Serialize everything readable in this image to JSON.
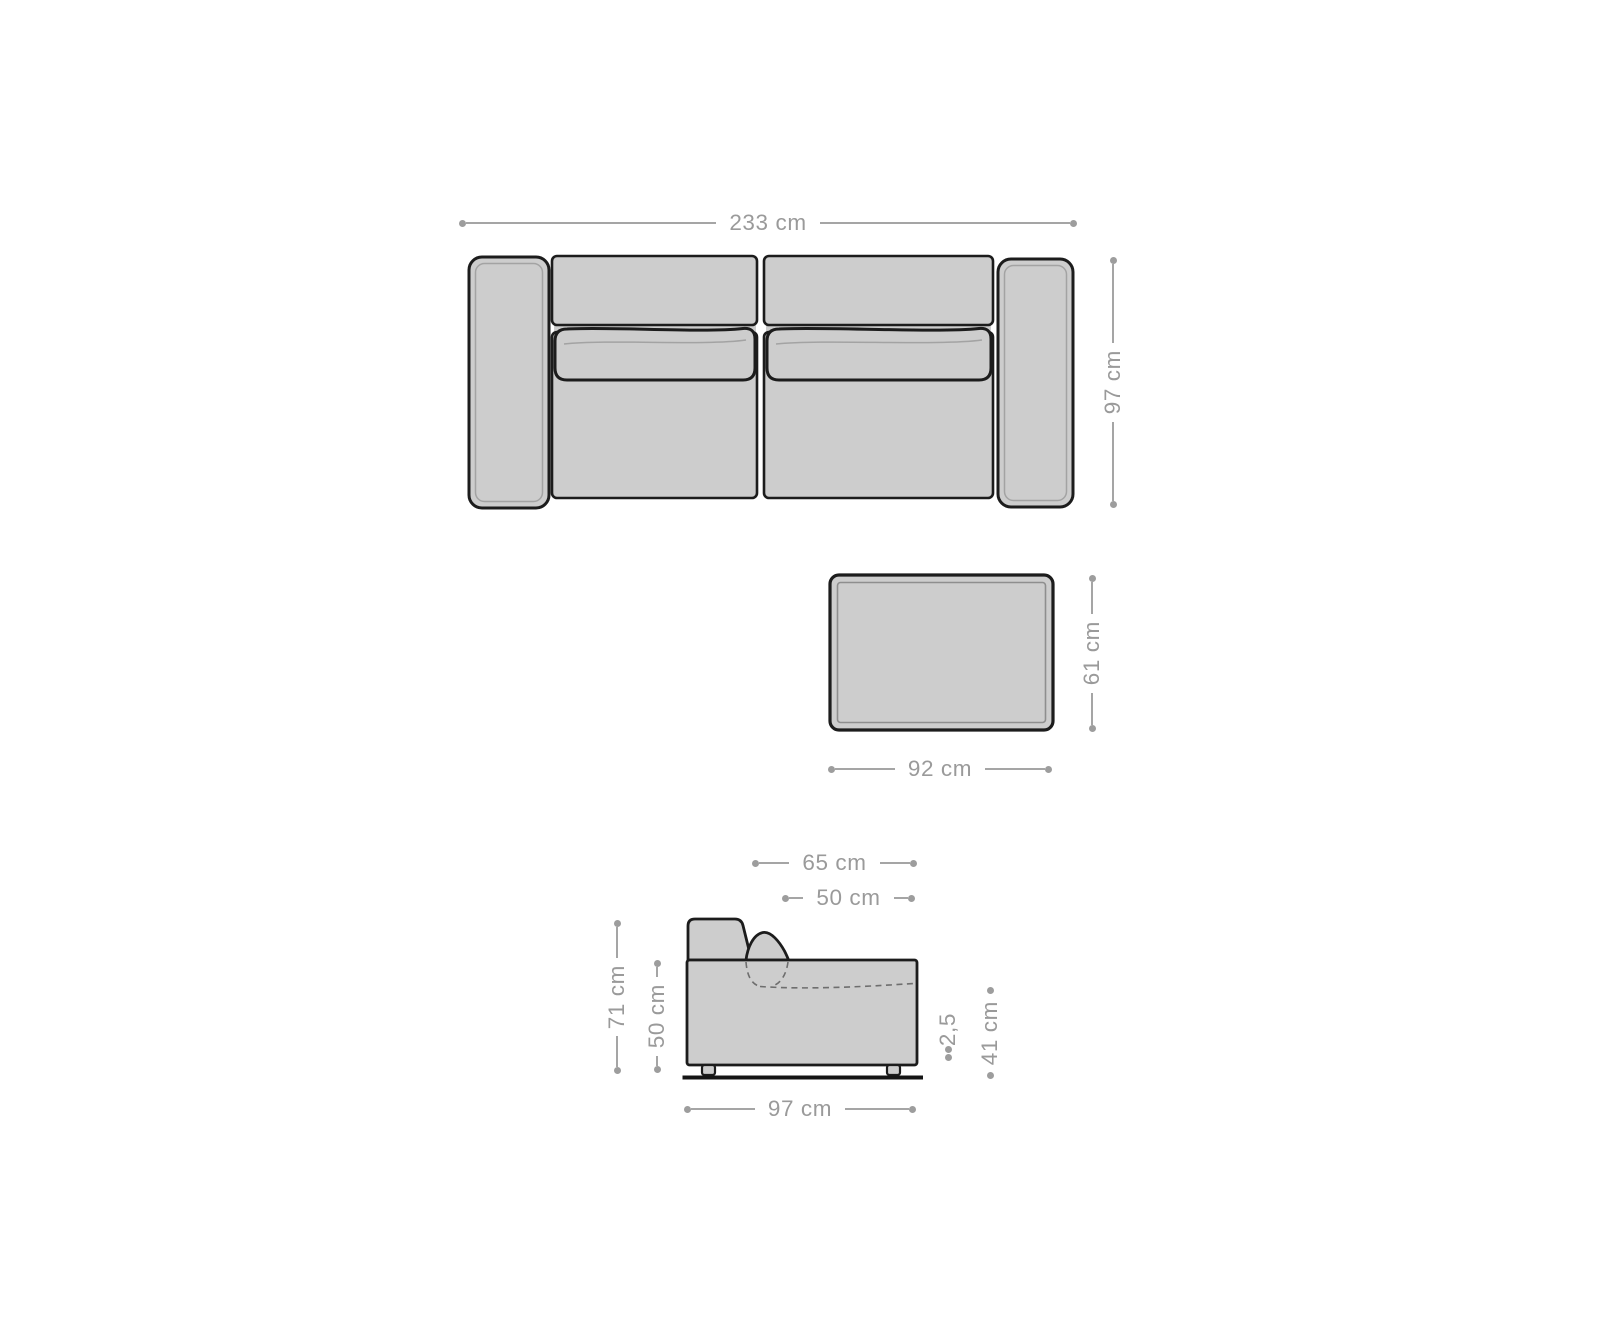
{
  "colors": {
    "background": "#ffffff",
    "furniture_fill": "#cdcdcd",
    "outline": "#1c1c1c",
    "inner_contour": "#9b9b9b",
    "hidden_dashed_line": "#6e6e6e",
    "dimension_gray": "#9d9d9d"
  },
  "sofa_top_view": {
    "overall_width": "233 cm",
    "overall_depth": "97 cm"
  },
  "ottoman_top_view": {
    "width": "92 cm",
    "depth": "61 cm"
  },
  "sofa_side_view": {
    "overall_depth": "65 cm",
    "seat_depth": "50 cm",
    "overall_height": "71 cm",
    "armrest_height": "50 cm",
    "leg_height": "2,5",
    "seat_height": "41 cm",
    "base_depth": "97 cm"
  }
}
